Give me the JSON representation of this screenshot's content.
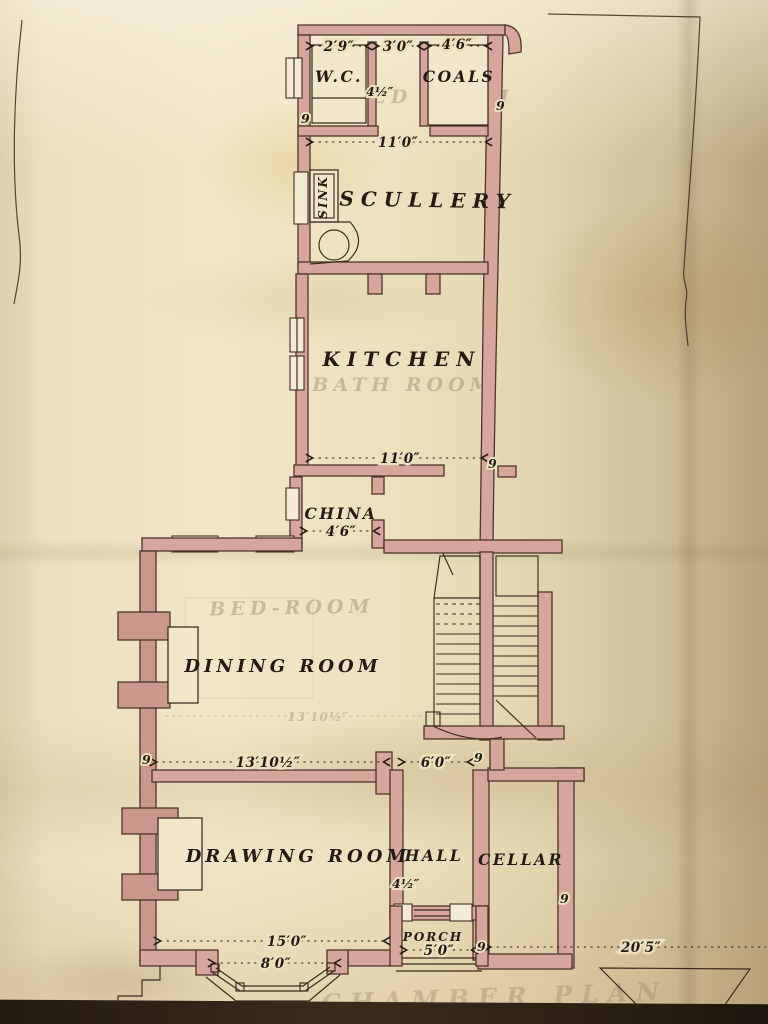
{
  "plan": {
    "rooms": {
      "wc": "W.C.",
      "coals": "COALS",
      "scullery": "SCULLERY",
      "sink": "SINK",
      "kitchen": "KITCHEN",
      "china": "CHINA",
      "dining_room": "DINING ROOM",
      "drawing_room": "DRAWING ROOM",
      "hall": "HALL",
      "cellar": "CELLAR",
      "porch": "PORCH"
    },
    "ghost": {
      "bed_room_rear": "BED ROOM",
      "bath_room": "BATH ROOM",
      "bed_room_front": "BED-ROOM",
      "dining_dim": "13′10½″",
      "sheet_title": "CHAMBER PLAN"
    },
    "dimensions": {
      "wc_width": "2′9″",
      "stair_well_width": "3′0″",
      "coals_width": "4′6″",
      "rear_block_width": "11′0″",
      "kitchen_width": "11′0″",
      "china_width": "4′6″",
      "dining_room_width": "13′10½″",
      "hall_width": "6′0″",
      "drawing_room_width": "15′0″",
      "bay_window_width": "8′0″",
      "porch_width": "5′0″",
      "right_wing_width": "20′5″"
    },
    "wall_marks": {
      "brick_9in": "9",
      "partition_4half": "4½″"
    },
    "colors": {
      "wall_fill": "#d6a59c",
      "ink": "#241b10",
      "paper": "#ece0bf",
      "ghost": "#8d7e60"
    }
  }
}
